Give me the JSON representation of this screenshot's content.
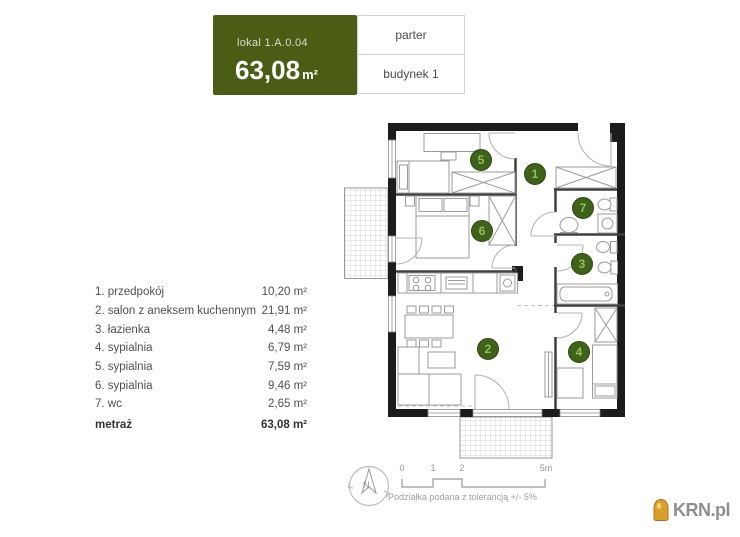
{
  "header": {
    "unit_label": "lokal 1.A.0.04",
    "area_value": "63,08",
    "area_unit": "m²",
    "floor": "parter",
    "building": "budynek 1"
  },
  "rooms": [
    {
      "label": "1. przedpokój",
      "area": "10,20 m²"
    },
    {
      "label": "2. salon z aneksem kuchennym",
      "area": "21,91 m²"
    },
    {
      "label": "3. łazienka",
      "area": "4,48 m²"
    },
    {
      "label": "4. sypialnia",
      "area": "6,79 m²"
    },
    {
      "label": "5. sypialnia",
      "area": "7,59 m²"
    },
    {
      "label": "6. sypialnia",
      "area": "9,46 m²"
    },
    {
      "label": "7. wc",
      "area": "2,65 m²"
    }
  ],
  "total": {
    "label": "metraż",
    "area": "63,08 m²"
  },
  "plan": {
    "badges": {
      "r1": "1",
      "r2": "2",
      "r3": "3",
      "r4": "4",
      "r5": "5",
      "r6": "6",
      "r7": "7"
    }
  },
  "scale": {
    "ticks": [
      "0",
      "1",
      "2",
      "5m"
    ],
    "note": "Podziałka podana z tolerancją +/- 5%"
  },
  "compass": {
    "north_label": "N"
  },
  "logo": {
    "text": "KRN.pl"
  },
  "colors": {
    "brand_green": "#4b5d14",
    "badge_green": "#3f6119",
    "logo_gold": "#d99f2b"
  }
}
